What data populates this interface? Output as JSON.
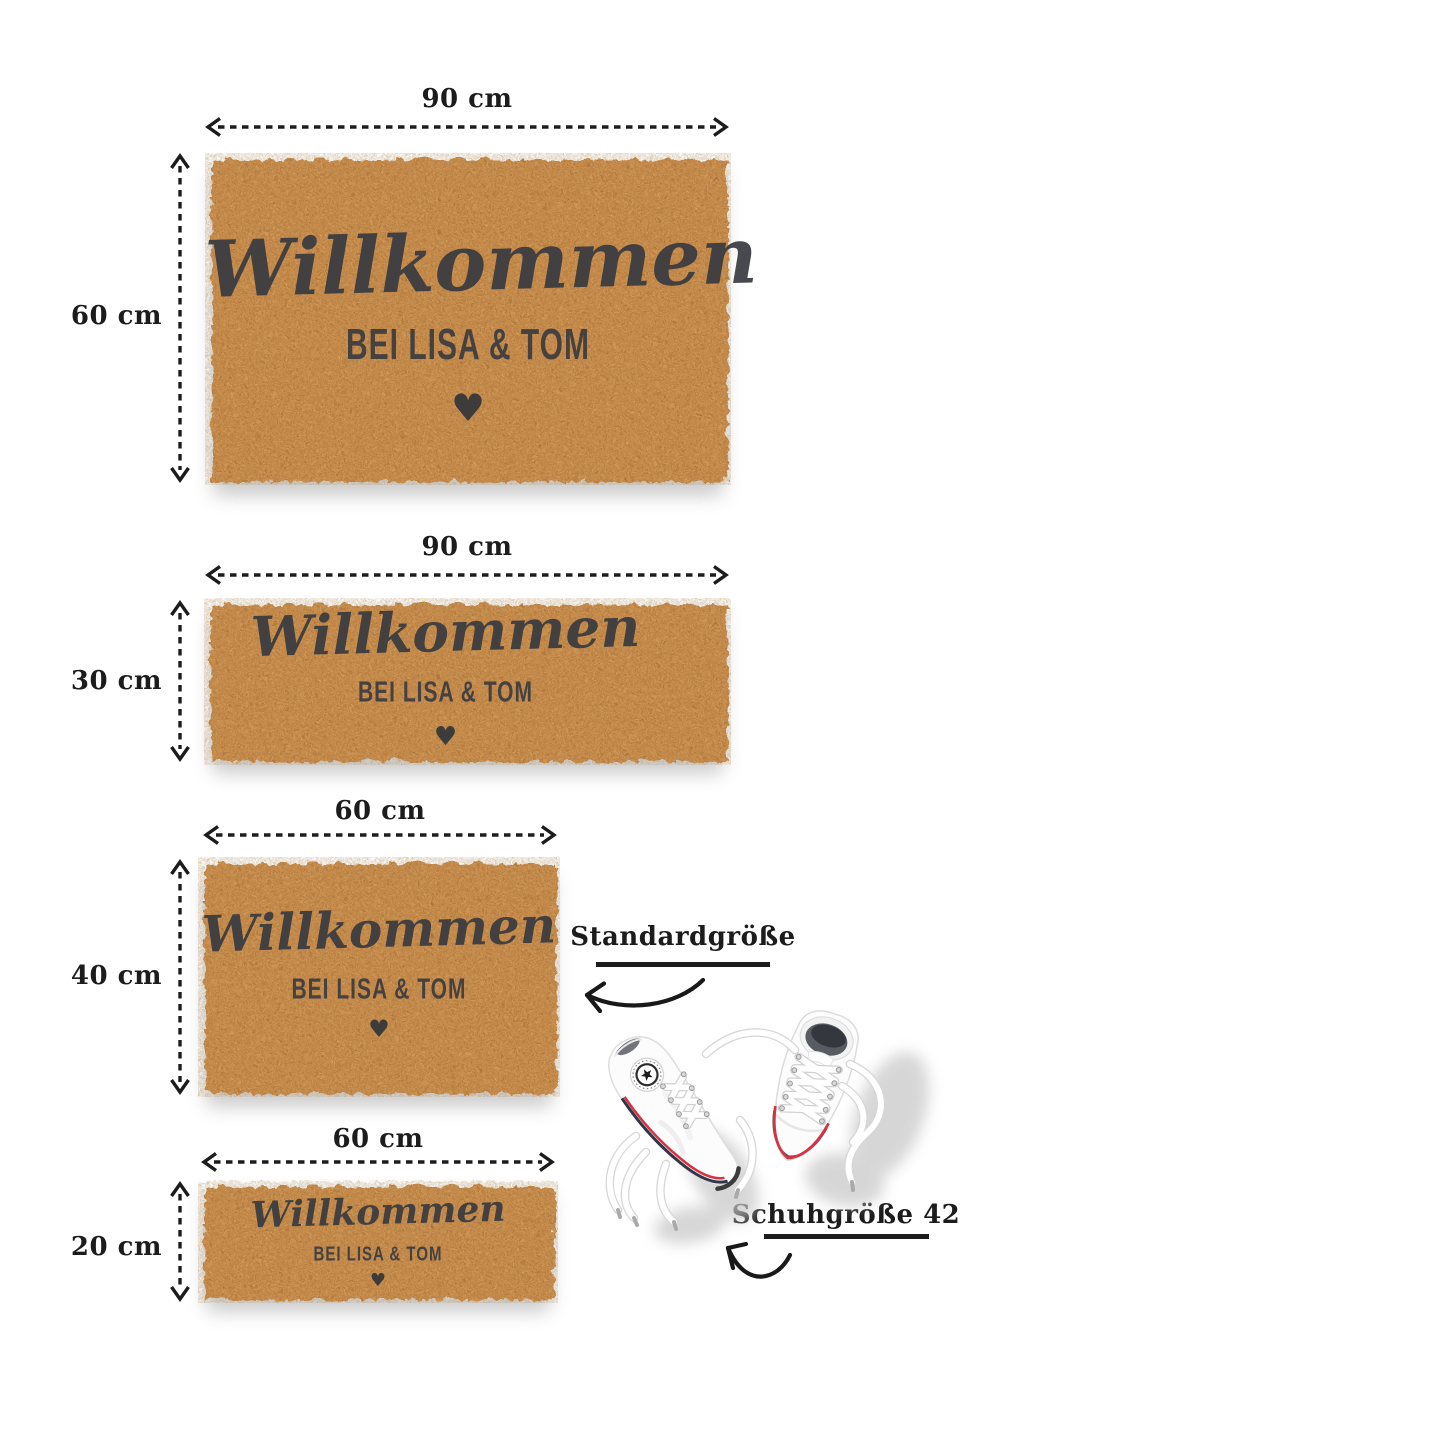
{
  "mats": [
    {
      "width_label": "90 cm",
      "height_label": "60 cm",
      "script_line": "Willkommen",
      "sub_line": "BEI LISA & TOM",
      "heart": "♥"
    },
    {
      "width_label": "90 cm",
      "height_label": "30 cm",
      "script_line": "Willkommen",
      "sub_line": "BEI LISA & TOM",
      "heart": "♥"
    },
    {
      "width_label": "60 cm",
      "height_label": "40 cm",
      "script_line": "Willkommen",
      "sub_line": "BEI LISA & TOM",
      "heart": "♥"
    },
    {
      "width_label": "60 cm",
      "height_label": "20 cm",
      "script_line": "Willkommen",
      "sub_line": "BEI LISA & TOM",
      "heart": "♥"
    }
  ],
  "annotations": {
    "standard_size": "Standardgröße",
    "shoe_size": "Schuhgröße 42"
  },
  "colors": {
    "mat_base": "#c9914f",
    "mat_print": "#383a40",
    "dimension_line": "#1c1c1c",
    "sneaker_red": "#d63340",
    "sneaker_navy": "#32354a",
    "background": "#ffffff"
  }
}
